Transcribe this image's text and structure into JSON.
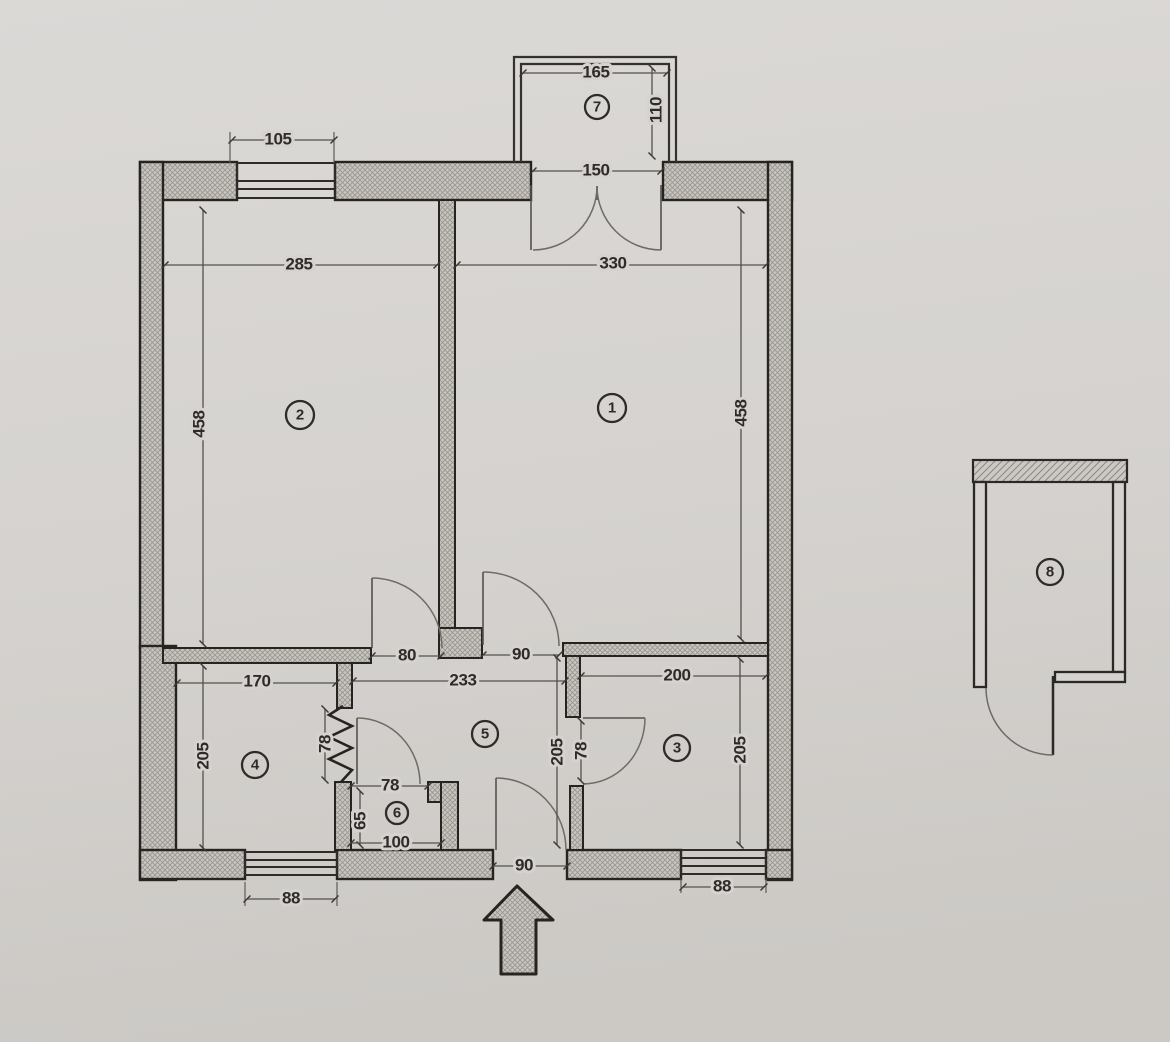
{
  "colors": {
    "paper": "#d5d2cf",
    "wall_outline": "#262421",
    "wall_fill": "#c9c6c2",
    "dim_line": "#55504b",
    "text_ink": "#2e2b28"
  },
  "rooms": {
    "r1": "1",
    "r2": "2",
    "r3": "3",
    "r4": "4",
    "r5": "5",
    "r6": "6",
    "r7": "7",
    "r8": "8"
  },
  "dims": {
    "top_window": "105",
    "balcony_width": "165",
    "balcony_depth": "110",
    "balcony_door": "150",
    "room2_width": "285",
    "room1_width": "330",
    "room2_height": "458",
    "room1_height": "458",
    "door_room2": "80",
    "door_room1": "90",
    "hall_width": "233",
    "room4_width": "170",
    "room4_height": "205",
    "room4_pass": "78",
    "hall_height": "205",
    "room3_door": "78",
    "room3_width": "200",
    "room3_height": "205",
    "room6_door": "78",
    "room6_depth": "65",
    "room6_width": "100",
    "entry_door": "90",
    "window_left": "88",
    "window_right": "88"
  }
}
